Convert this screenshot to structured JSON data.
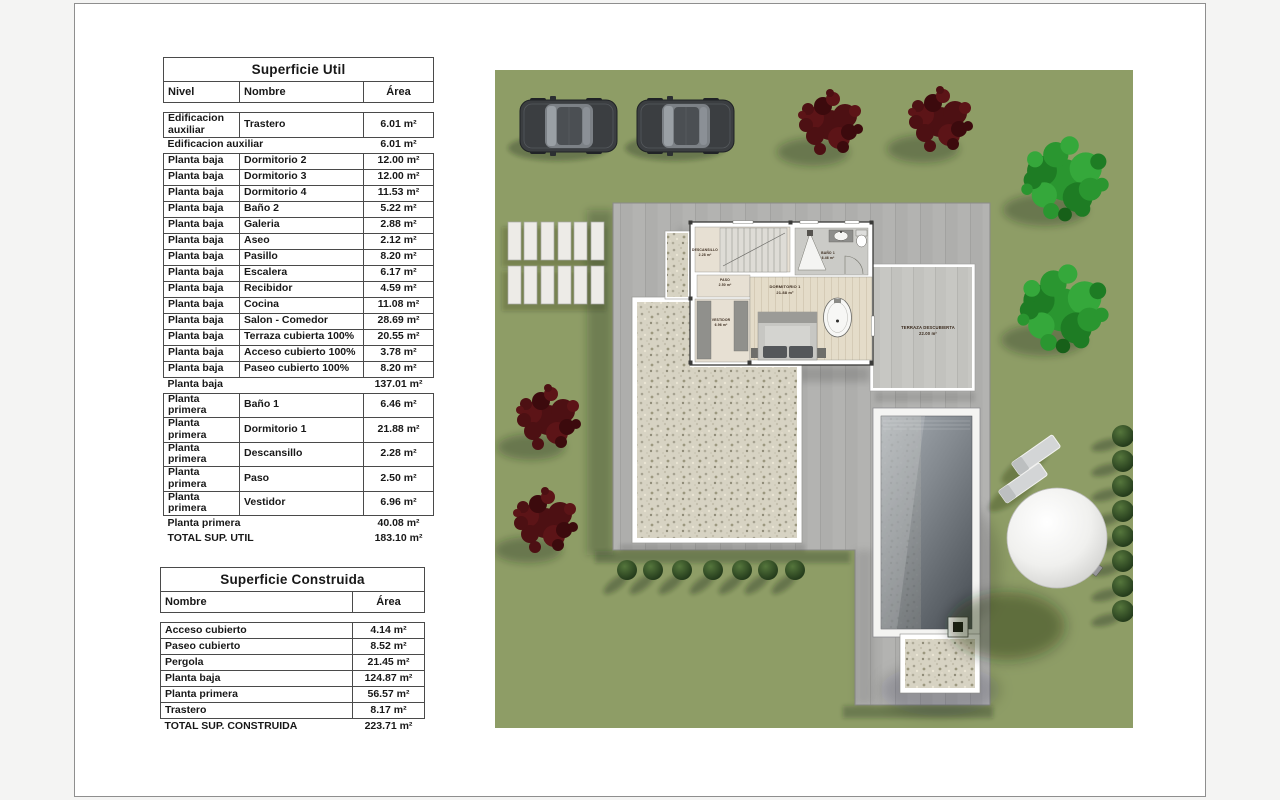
{
  "tables": {
    "util": {
      "title": "Superficie Util",
      "headers": {
        "nivel": "Nivel",
        "nombre": "Nombre",
        "area": "Área"
      },
      "rows": [
        {
          "kind": "data",
          "nivel": "Edificacion auxiliar",
          "nombre": "Trastero",
          "area": "6.01 m²"
        },
        {
          "kind": "subtotal",
          "label": "Edificacion auxiliar",
          "area": "6.01 m²"
        },
        {
          "kind": "data",
          "nivel": "Planta baja",
          "nombre": "Dormitorio 2",
          "area": "12.00 m²"
        },
        {
          "kind": "data",
          "nivel": "Planta baja",
          "nombre": "Dormitorio 3",
          "area": "12.00 m²"
        },
        {
          "kind": "data",
          "nivel": "Planta baja",
          "nombre": "Dormitorio 4",
          "area": "11.53 m²"
        },
        {
          "kind": "data",
          "nivel": "Planta baja",
          "nombre": "Baño 2",
          "area": "5.22 m²"
        },
        {
          "kind": "data",
          "nivel": "Planta baja",
          "nombre": "Galeria",
          "area": "2.88 m²"
        },
        {
          "kind": "data",
          "nivel": "Planta baja",
          "nombre": "Aseo",
          "area": "2.12 m²"
        },
        {
          "kind": "data",
          "nivel": "Planta baja",
          "nombre": "Pasillo",
          "area": "8.20 m²"
        },
        {
          "kind": "data",
          "nivel": "Planta baja",
          "nombre": "Escalera",
          "area": "6.17 m²"
        },
        {
          "kind": "data",
          "nivel": "Planta baja",
          "nombre": "Recibidor",
          "area": "4.59 m²"
        },
        {
          "kind": "data",
          "nivel": "Planta baja",
          "nombre": "Cocina",
          "area": "11.08 m²"
        },
        {
          "kind": "data",
          "nivel": "Planta baja",
          "nombre": "Salon - Comedor",
          "area": "28.69 m²"
        },
        {
          "kind": "data",
          "nivel": "Planta baja",
          "nombre": "Terraza cubierta 100%",
          "area": "20.55 m²"
        },
        {
          "kind": "data",
          "nivel": "Planta baja",
          "nombre": "Acceso cubierto 100%",
          "area": "3.78 m²"
        },
        {
          "kind": "data",
          "nivel": "Planta baja",
          "nombre": "Paseo cubierto 100%",
          "area": "8.20 m²"
        },
        {
          "kind": "subtotal",
          "label": "Planta baja",
          "area": "137.01 m²"
        },
        {
          "kind": "data",
          "nivel": "Planta primera",
          "nombre": "Baño 1",
          "area": "6.46 m²"
        },
        {
          "kind": "data",
          "nivel": "Planta primera",
          "nombre": "Dormitorio 1",
          "area": "21.88 m²"
        },
        {
          "kind": "data",
          "nivel": "Planta primera",
          "nombre": "Descansillo",
          "area": "2.28 m²"
        },
        {
          "kind": "data",
          "nivel": "Planta primera",
          "nombre": "Paso",
          "area": "2.50 m²"
        },
        {
          "kind": "data",
          "nivel": "Planta primera",
          "nombre": "Vestidor",
          "area": "6.96 m²"
        },
        {
          "kind": "subtotal",
          "label": "Planta primera",
          "area": "40.08 m²"
        },
        {
          "kind": "total",
          "label": "TOTAL SUP. UTIL",
          "area": "183.10 m²"
        }
      ]
    },
    "construida": {
      "title": "Superficie Construida",
      "headers": {
        "nombre": "Nombre",
        "area": "Área"
      },
      "rows": [
        {
          "kind": "data",
          "nombre": "Acceso cubierto",
          "area": "4.14 m²"
        },
        {
          "kind": "data",
          "nombre": "Paseo cubierto",
          "area": "8.52 m²"
        },
        {
          "kind": "data",
          "nombre": "Pergola",
          "area": "21.45 m²"
        },
        {
          "kind": "data",
          "nombre": "Planta baja",
          "area": "124.87 m²"
        },
        {
          "kind": "data",
          "nombre": "Planta primera",
          "area": "56.57 m²"
        },
        {
          "kind": "data",
          "nombre": "Trastero",
          "area": "8.17 m²"
        },
        {
          "kind": "total",
          "label": "TOTAL SUP. CONSTRUIDA",
          "area": "223.71 m²"
        }
      ]
    }
  },
  "plan": {
    "rooms": {
      "descansillo": {
        "name": "DESCANSILLO",
        "area": "2.28 m²"
      },
      "bano1": {
        "name": "BAÑO 1",
        "area": "6.46 m²"
      },
      "paso": {
        "name": "PASO",
        "area": "2.50 m²"
      },
      "dormitorio1": {
        "name": "DORMITORIO 1",
        "area": "21.88 m²"
      },
      "vestidor": {
        "name": "VESTIDOR",
        "area": "6.96 m²"
      },
      "terraza": {
        "name": "TERRAZA DESCUBIERTA",
        "area": "22.00 m²"
      }
    },
    "colors": {
      "grass": "#8e9d66",
      "paving": "#b3b3b1",
      "terrace_paving": "#c7c7c3",
      "gravel": "#d7d3c3",
      "pool_deep": "#53595f",
      "tree_green": "#2a9630",
      "tree_maroon": "#4d1013"
    }
  }
}
